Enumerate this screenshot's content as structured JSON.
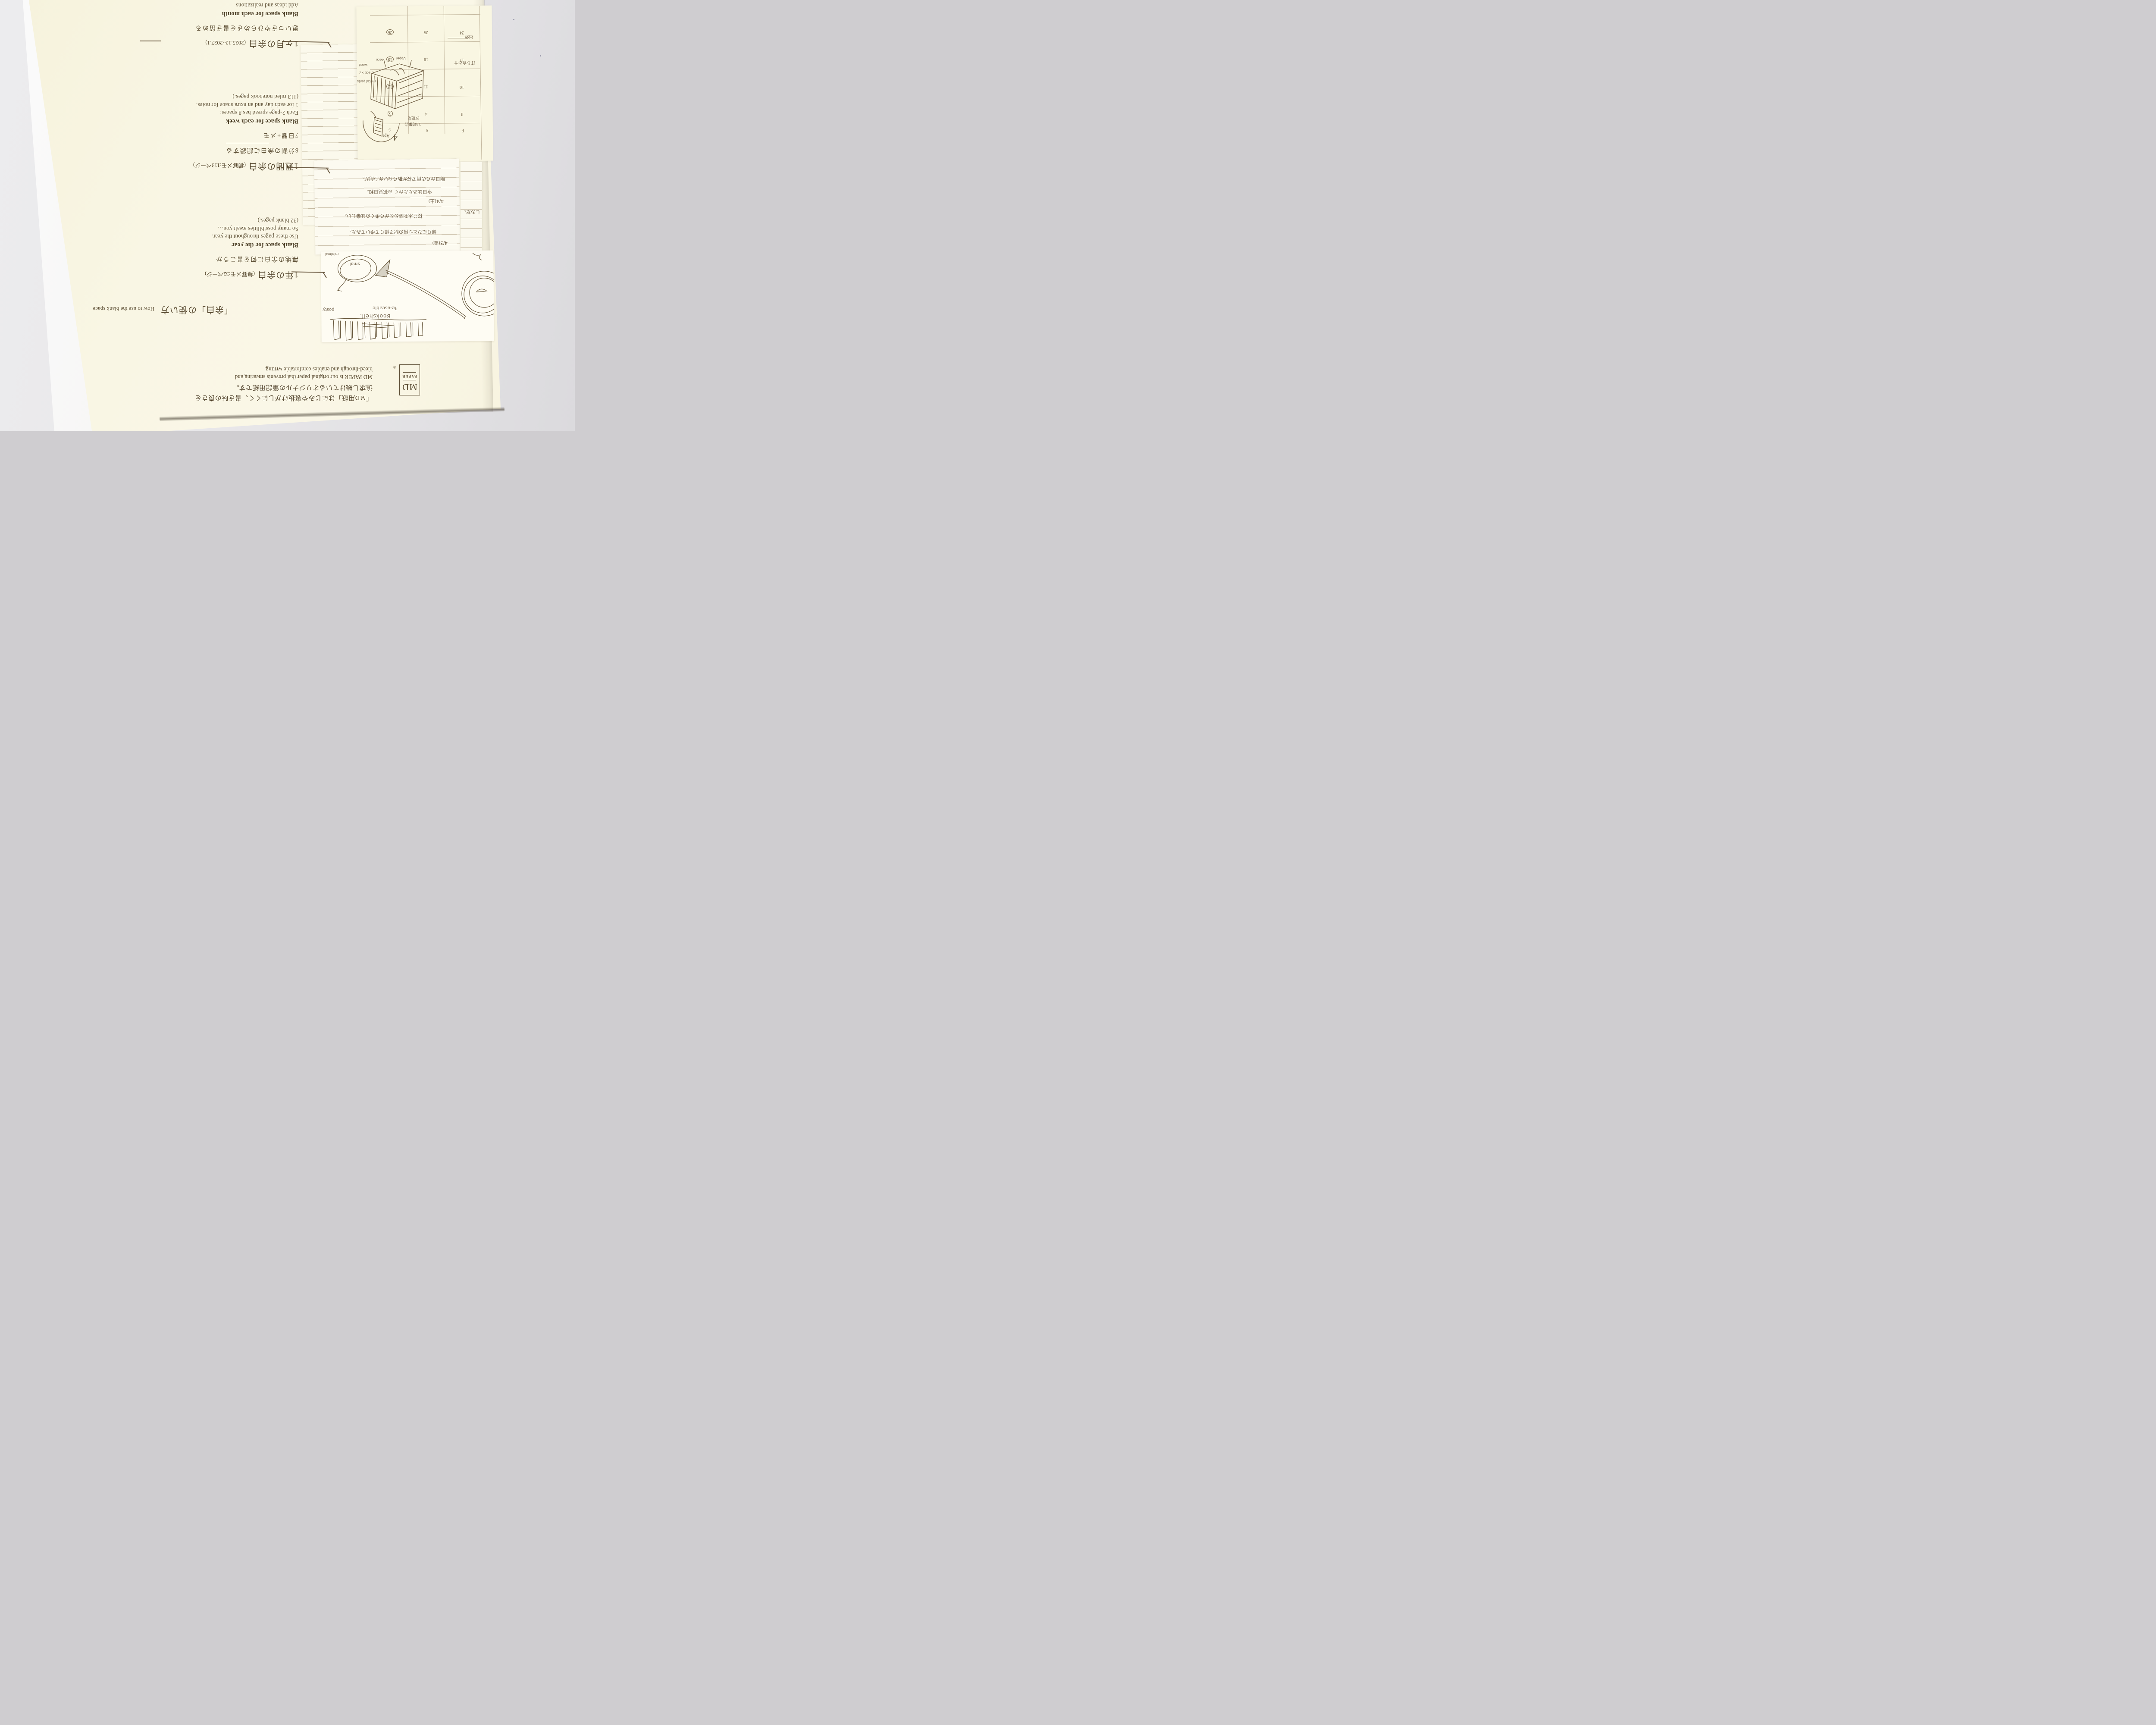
{
  "package": {
    "logo": {
      "md": "MD",
      "paper": "PAPER",
      "reg": "®"
    },
    "intro": {
      "jp1": "「MD用紙」はにじみや裏抜けがしにくく、書き味の良さを",
      "jp2": "追求し続けているオリジナルの筆記用紙です。",
      "en1": "MD PAPER is our original paper that prevents smearing and",
      "en2": "bleed-through and enables comfortable writing."
    },
    "usage": {
      "jp": "「余白」の使い方",
      "en": "How to use the blank space"
    },
    "sections": {
      "year": {
        "heading": "1年の余白",
        "note": "(無罫メモ:32ページ)",
        "tagline": "無地の余白に何を書こうか",
        "title": "Blank space for the year",
        "line1": "Use these pages throughout the year.",
        "line2": "So many possibilities await you…",
        "line3": "(32 blank pages.)"
      },
      "week": {
        "heading": "1週間の余白",
        "note": "(横罫メモ:113ページ)",
        "tagline": "8分割の余白に記録する",
        "tagline2": "7日間+メモ",
        "title": "Blank space for each week",
        "line1": "Each 2-page spread has 8 spaces:",
        "line2": "1 for each day and an extra space for notes.",
        "line3": "(113 ruled notebook pages.)"
      },
      "month": {
        "heading": "1ヶ月の余白",
        "note": "(2025.12~2027.1)",
        "tagline": "思いつきやひらめきを書き留める",
        "title": "Blank space for each month",
        "line1": "Add ideas and realizations"
      }
    }
  },
  "calendar": {
    "month_num": "4",
    "month_name": "Apr",
    "headers": [
      "F",
      "S",
      "S"
    ],
    "weeks": [
      [
        "3",
        "4",
        "5"
      ],
      [
        "10",
        "11",
        "12"
      ],
      [
        "17",
        "18",
        "19"
      ],
      [
        "24",
        "25",
        "26"
      ]
    ],
    "circled_days": [
      "5",
      "12",
      "19",
      "26"
    ],
    "notes": {
      "trip": "出張",
      "meeting": "打ち合わせ",
      "hanami1": "お花見",
      "hanami2": "15時集合"
    }
  },
  "diary": {
    "e1_date": "4/3(金)",
    "e1_l1": "帰りにひとつ隣の駅で降りて歩いてみた。",
    "e1_l2": "桜並木を眺めながら歩くのは楽しい。",
    "e2_date": "4/4(土)",
    "e2_l1": "今日はあたたかく お花見日和。",
    "e2_l2": "明日からの雨で桜が散らないか心配だ。",
    "fragment": "しみだ。"
  },
  "sketchcard": {
    "minimal": "minimal",
    "small": "small",
    "posty": "posty",
    "reuse": "Re-useable",
    "bookshelf": "Bookshelf."
  },
  "boxsketch": {
    "piece": "Piece",
    "upper": "Upper",
    "wood": "wood",
    "black": "black ×2",
    "metal": "metal parts"
  }
}
